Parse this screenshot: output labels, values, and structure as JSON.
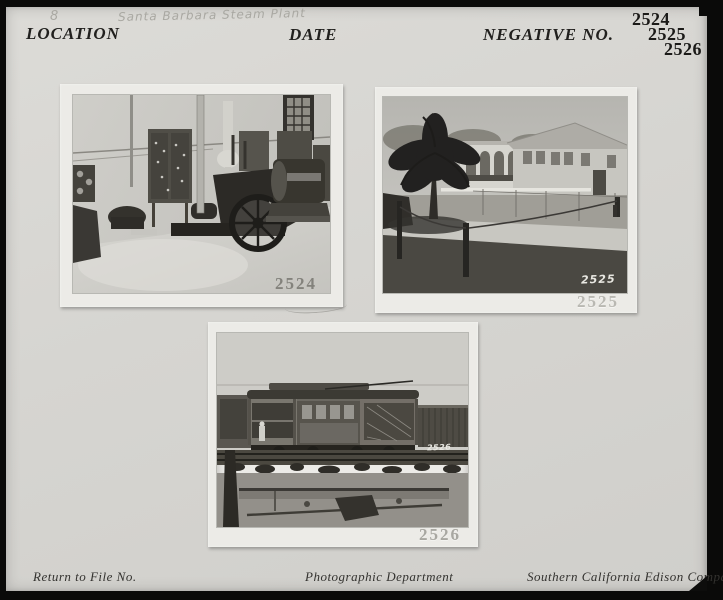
{
  "header": {
    "page_number": "8",
    "handwritten_location": "Santa Barbara Steam Plant",
    "location_label": "LOCATION",
    "date_label": "DATE",
    "negative_label": "NEGATIVE NO.",
    "negative_numbers": [
      "2524",
      "2525",
      "2526"
    ]
  },
  "photos": [
    {
      "stamp": "2524",
      "description": "Interior of Santa Barbara Steam Plant engine room with switchboard panels, steam engine with flywheel, and generator beneath a window"
    },
    {
      "stamp": "2525",
      "handwritten_number": "2525",
      "description": "Exterior of Santa Barbara Steam Plant building with gabled roof and arched windows, large palm tree, lawn and rope fence in foreground"
    },
    {
      "stamp": "2526",
      "handwritten_number": "2526",
      "description": "Electric streetcar with open platforms on tracks, wooden freight car behind, dirt and excavation in foreground"
    }
  ],
  "footer": {
    "return_label": "Return to File No.",
    "department": "Photographic Department",
    "company": "Southern California Edison Company"
  },
  "colors": {
    "scan_background": "#0a0a09",
    "page": "#d6d5d1",
    "mat": "#ecebe7",
    "ink": "#1b1a18",
    "pencil": "#a9a8a2",
    "stamp_on_photo": "#83827c",
    "stamp_on_mat": "#b9b8b2"
  }
}
